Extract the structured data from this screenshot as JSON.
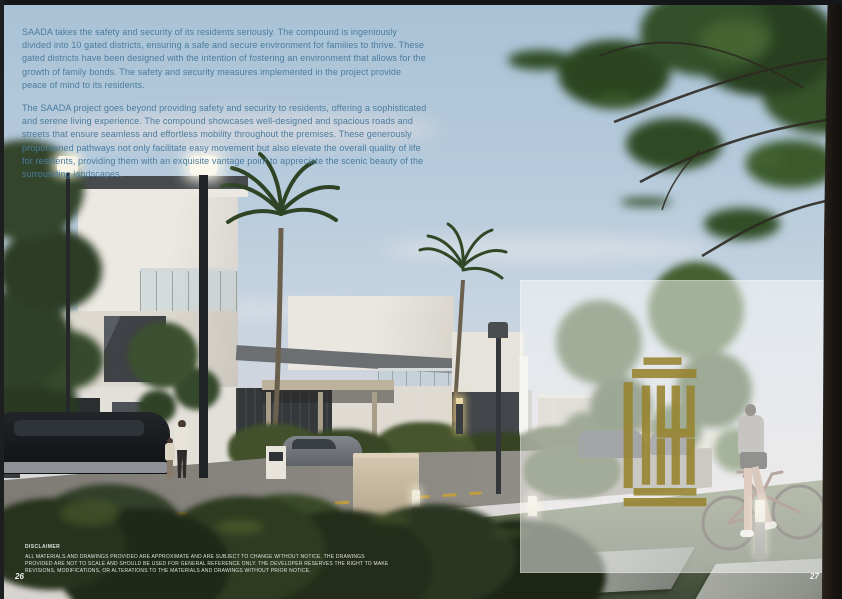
{
  "intro": {
    "paragraph1": "SAADA takes the safety and security of its residents seriously. The compound is ingeniously divided into 10 gated districts, ensuring a safe and secure environment for families to thrive. These gated districts have been designed with the intention of fostering an environment that allows for the growth of family bonds. The safety and security measures implemented in the project provide peace of mind to its residents.",
    "paragraph2": "The SAADA project goes beyond providing safety and security to residents, offering a sophisticated and serene living experience. The compound showcases well-designed and spacious roads and streets that ensure seamless and effortless mobility throughout the premises. These generously proportioned pathways not only facilitate easy movement but also elevate the overall quality of life for residents, providing them with an exquisite vantage point to appreciate the scenic beauty of the surrounding landscapes."
  },
  "disclaimer": {
    "heading": "DISCLAIMER",
    "body": "ALL MATERIALS AND DRAWINGS PROVIDED ARE APPROXIMATE AND ARE SUBJECT TO CHANGE WITHOUT NOTICE. THE DRAWINGS PROVIDED ARE NOT TO SCALE AND SHOULD BE USED FOR GENERAL REFERENCE ONLY. THE DEVELOPER RESERVES THE RIGHT TO MAKE REVISIONS, MODIFICATIONS, OR ALTERATIONS TO THE MATERIALS AND DRAWINGS WITHOUT PRIOR NOTICE."
  },
  "pages": {
    "left_number": "26",
    "right_number": "27"
  },
  "branding": {
    "logo": "saada-kufic-logo",
    "logo_color": "#97832e"
  },
  "colors": {
    "intro_text": "#4a7c9e",
    "overlay_panel": "rgba(252,252,250,0.52)",
    "sky_top": "#a9c2d6",
    "sky_horizon": "#ded9d8"
  }
}
